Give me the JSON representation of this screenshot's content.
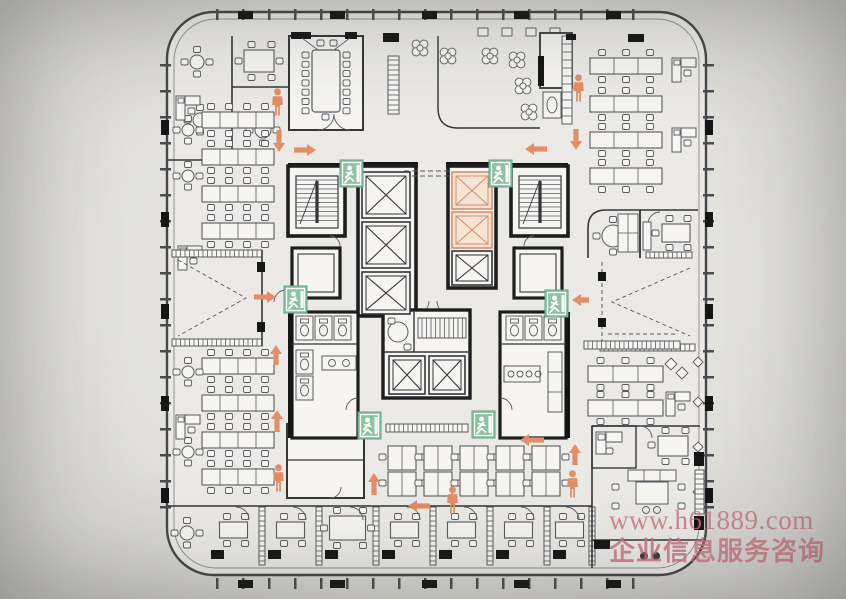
{
  "watermark": {
    "line1": "www.h61889.com",
    "line2": "企业信息服务咨询",
    "color": "#c5737b"
  },
  "plan": {
    "colors": {
      "wall": "#35353a",
      "line": "#5a5a60",
      "room_fill": "#f6f5f2",
      "building_fill": "#ebeae6",
      "outline": "#46464a",
      "block": "#161616",
      "exit_green": "#8cc4a2",
      "exit_border": "#5ea57f",
      "route_orange": "#e28e67",
      "highlight_fill": "#f7e4d4",
      "highlight_stroke": "#d4906e"
    },
    "exit_signs": [
      {
        "x": 340,
        "y": 160
      },
      {
        "x": 489,
        "y": 160
      },
      {
        "x": 284,
        "y": 286
      },
      {
        "x": 545,
        "y": 290
      },
      {
        "x": 358,
        "y": 412
      },
      {
        "x": 472,
        "y": 411
      }
    ],
    "evac_persons": [
      {
        "x": 271,
        "y": 88
      },
      {
        "x": 572,
        "y": 74
      },
      {
        "x": 272,
        "y": 464
      },
      {
        "x": 446,
        "y": 486
      },
      {
        "x": 566,
        "y": 470
      }
    ],
    "evac_arrows": [
      {
        "x": 294,
        "y": 150,
        "dir": "right",
        "len": 13
      },
      {
        "x": 279,
        "y": 130,
        "dir": "down",
        "len": 13
      },
      {
        "x": 547,
        "y": 149,
        "dir": "left",
        "len": 13
      },
      {
        "x": 576,
        "y": 129,
        "dir": "down",
        "len": 12
      },
      {
        "x": 254,
        "y": 297,
        "dir": "right",
        "len": 13
      },
      {
        "x": 589,
        "y": 300,
        "dir": "left",
        "len": 8
      },
      {
        "x": 276,
        "y": 365,
        "dir": "up",
        "len": 11
      },
      {
        "x": 277,
        "y": 432,
        "dir": "up",
        "len": 13
      },
      {
        "x": 374,
        "y": 495,
        "dir": "up",
        "len": 13
      },
      {
        "x": 430,
        "y": 506,
        "dir": "left",
        "len": 13
      },
      {
        "x": 544,
        "y": 440,
        "dir": "left",
        "len": 15
      },
      {
        "x": 575,
        "y": 465,
        "dir": "up",
        "len": 12
      }
    ],
    "elevators": [
      {
        "x": 362,
        "y": 172,
        "w": 48,
        "h": 46,
        "highlight": false
      },
      {
        "x": 362,
        "y": 222,
        "w": 48,
        "h": 46,
        "highlight": false
      },
      {
        "x": 362,
        "y": 272,
        "w": 48,
        "h": 42,
        "highlight": false
      },
      {
        "x": 452,
        "y": 172,
        "w": 40,
        "h": 37,
        "highlight": true
      },
      {
        "x": 452,
        "y": 212,
        "w": 40,
        "h": 36,
        "highlight": true
      },
      {
        "x": 452,
        "y": 251,
        "w": 40,
        "h": 34,
        "highlight": false
      },
      {
        "x": 389,
        "y": 356,
        "w": 36,
        "h": 38,
        "highlight": false
      },
      {
        "x": 429,
        "y": 356,
        "w": 36,
        "h": 38,
        "highlight": false
      }
    ]
  }
}
